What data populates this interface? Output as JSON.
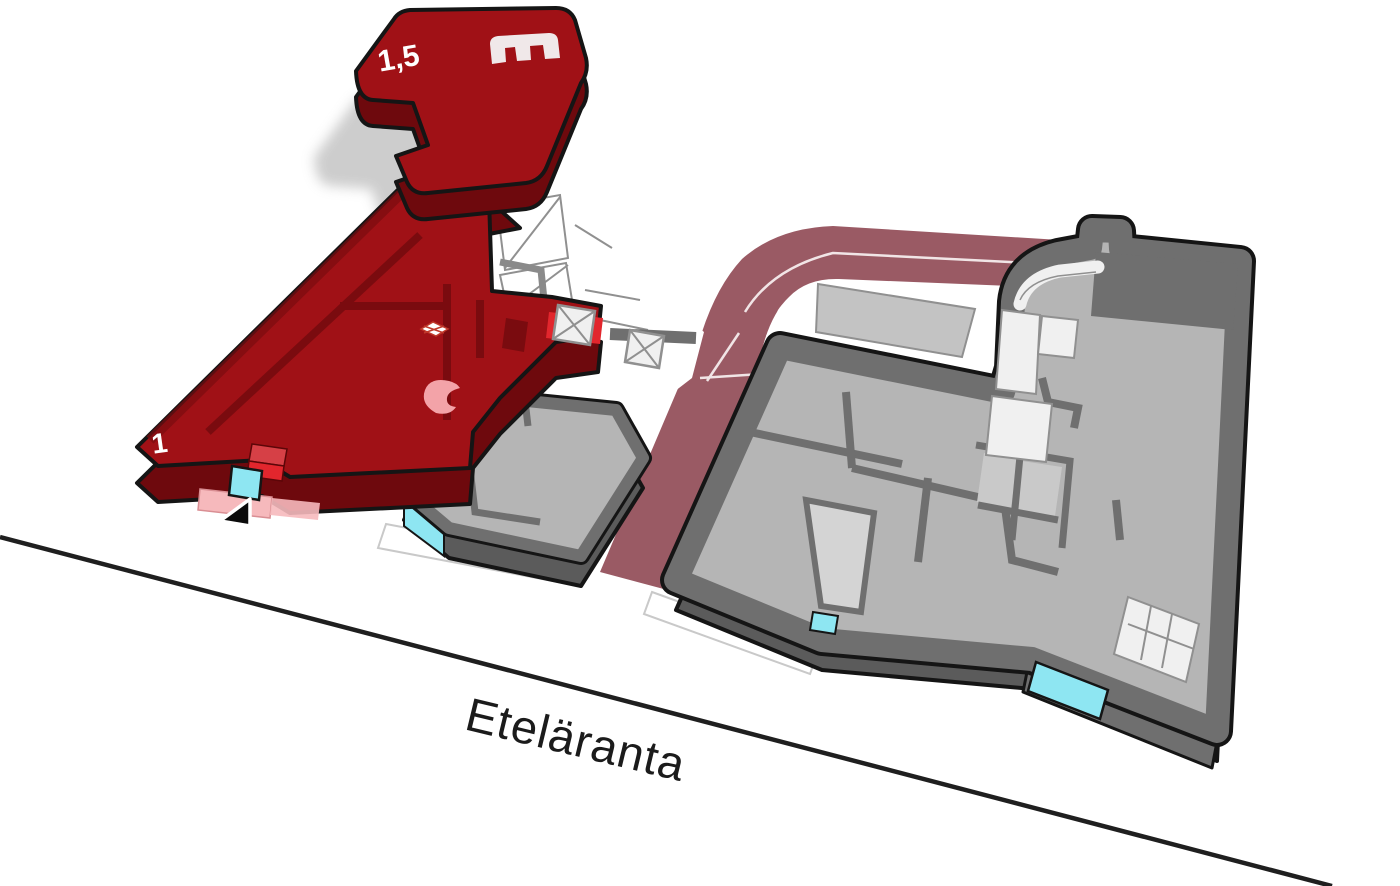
{
  "diagram": {
    "street_label": "Eteläranta",
    "highlighted_building": {
      "upper_floor_label": "1,5",
      "main_floor_label": "1"
    }
  },
  "icons": {
    "entrance_arrow": "entrance-arrow-icon",
    "roof_logo": "roof-logo-icon",
    "shaft_boxes": "shaft-x-icon",
    "pink_marker": "pink-comma-marker"
  },
  "colors": {
    "background": "#ffffff",
    "outline": "#151515",
    "street_line": "#1f1f1f",
    "text": "#1b1b1b",
    "shadow": "#c8c8c8",
    "red_top": "#a01116",
    "red_side": "#6e090d",
    "red_wall_line": "#7a0b0f",
    "red_bright": "#e2262d",
    "red_bright_top": "#d64046",
    "pink": "#f3a3a8",
    "pink_light": "#f6b9bc",
    "cyan": "#8ee6f2",
    "driveway": "#9a5a64",
    "lane": "#f6edee",
    "gray_wall": "#6f6f6f",
    "gray_wall_dark": "#5b5b5b",
    "gray_floor": "#b5b5b5",
    "gray_floor_light": "#c9c9c9",
    "room_white": "#f0f0f0",
    "room_line": "#909090",
    "ground_line": "#c9c9c9",
    "courtyard_rect": "#c3c3c3",
    "light_room": "#d4d4d4"
  }
}
